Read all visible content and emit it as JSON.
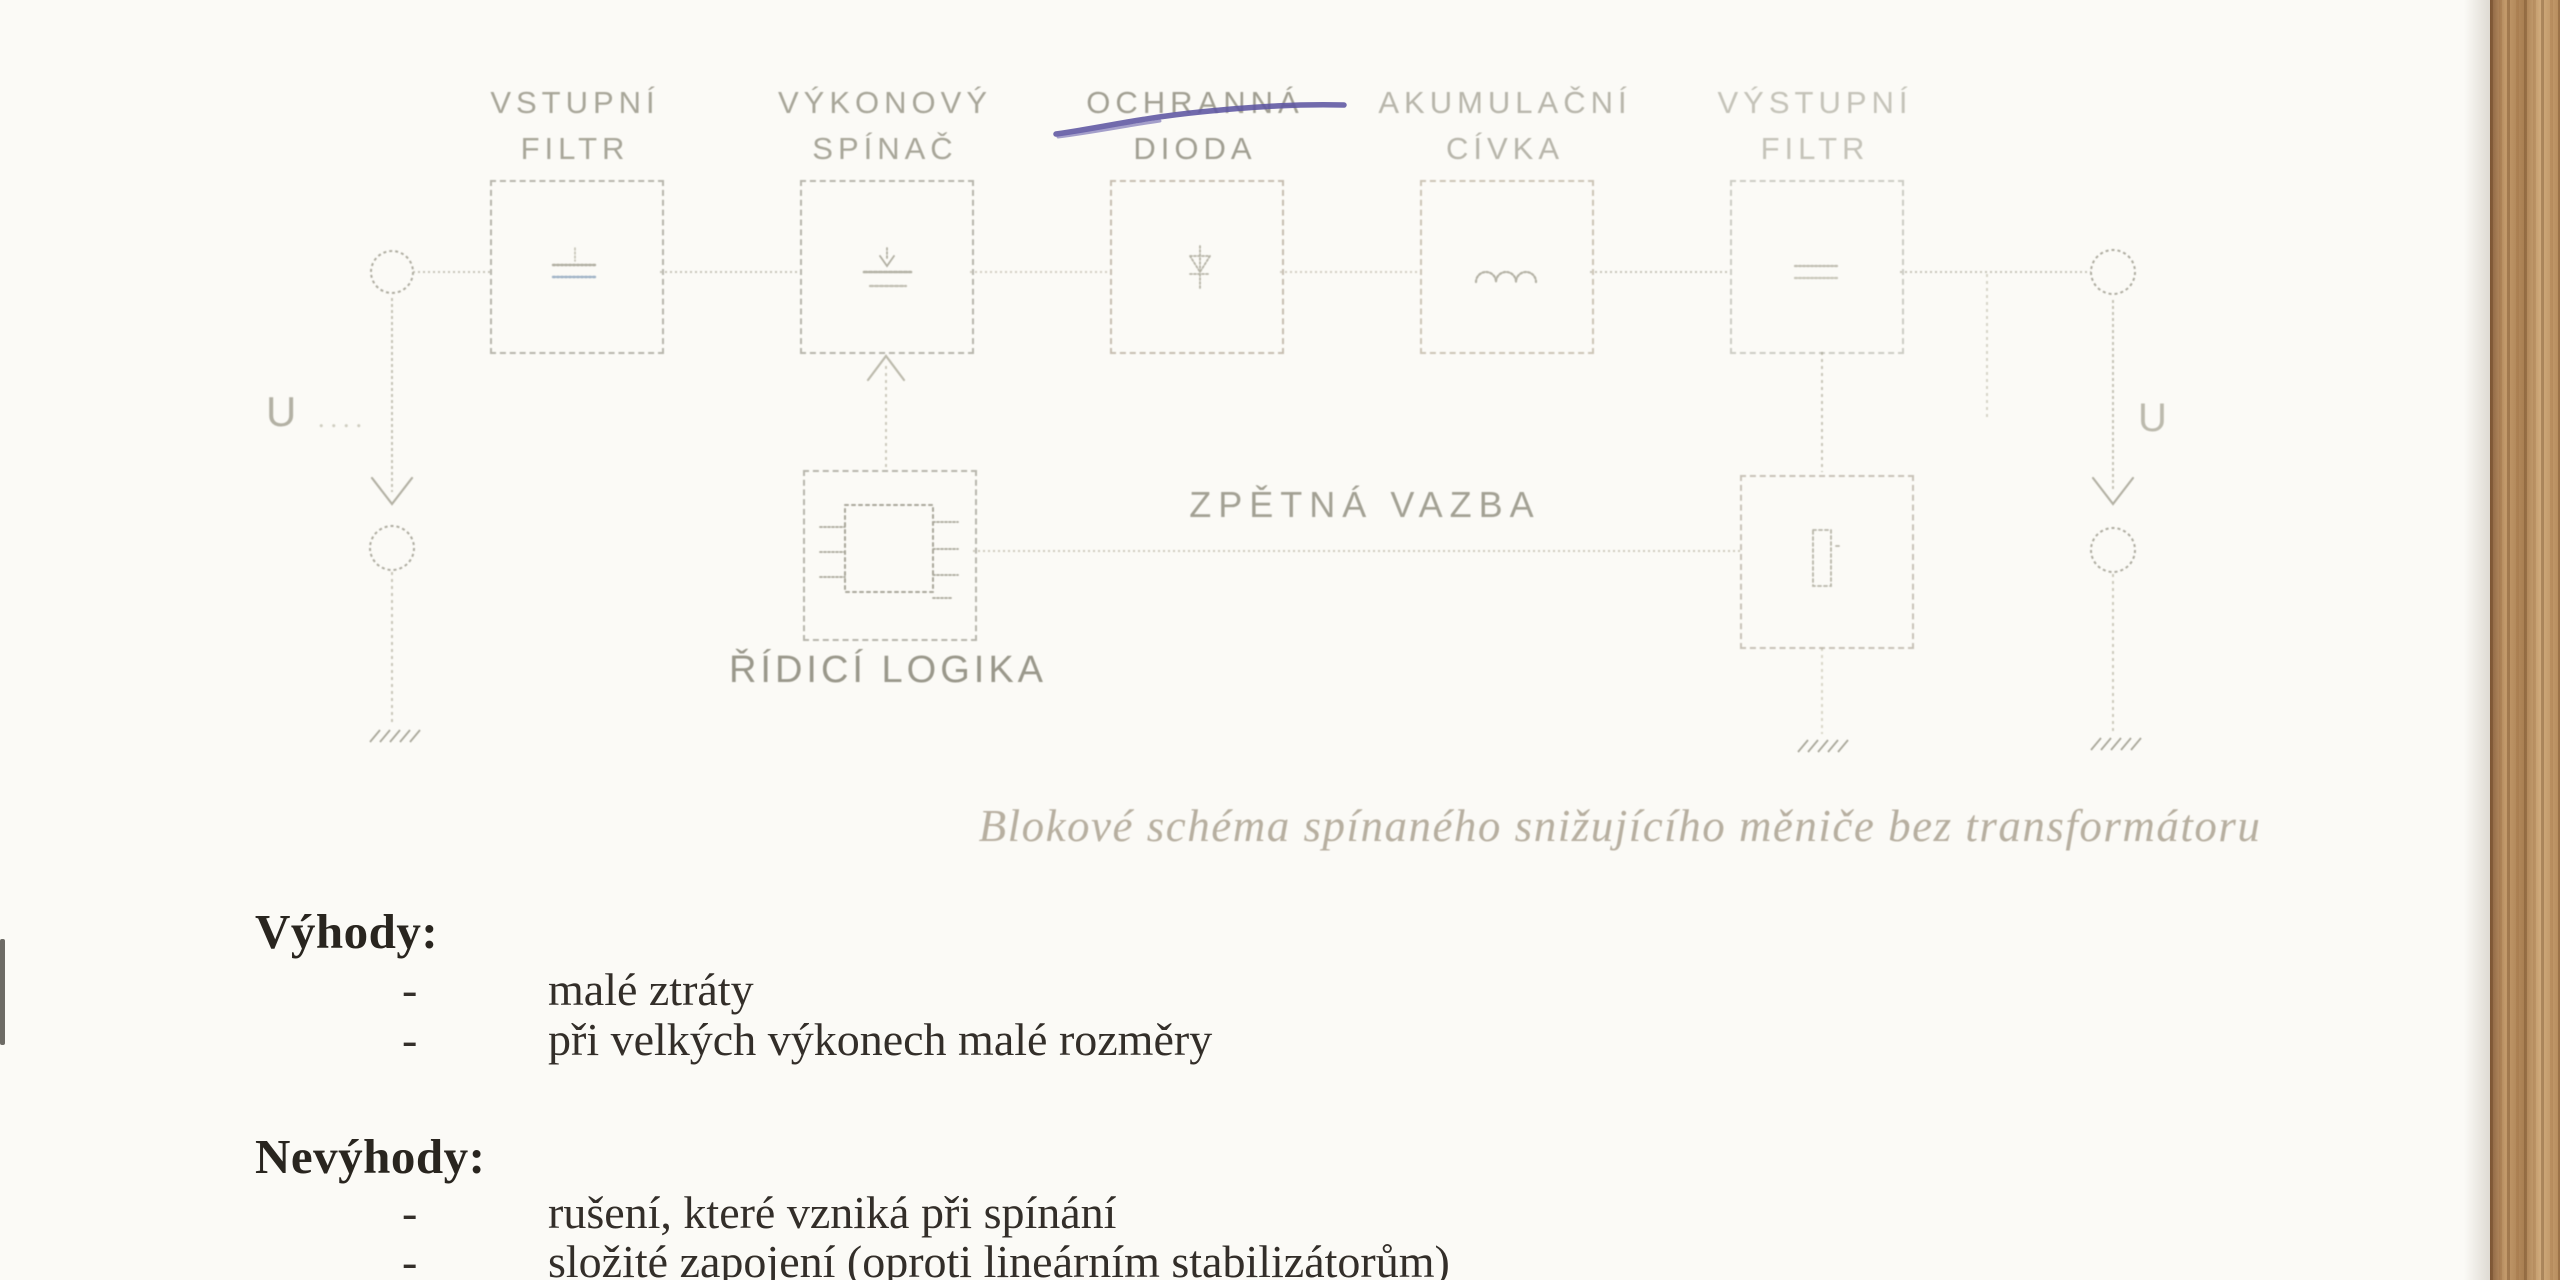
{
  "page": {
    "kind": "scanned textbook page",
    "language": "cs",
    "colors": {
      "paper": "#fbfaf6",
      "diagram_line": "#c6c4b7",
      "pen_ink": "#5d55a2",
      "body_text": "#2f2b26",
      "wood_desk": "#b5895f"
    }
  },
  "diagram": {
    "blocks": [
      {
        "line1": "VSTUPNÍ",
        "line2": "FILTR",
        "symbol": "capacitor-filter-icon"
      },
      {
        "line1": "VÝKONOVÝ",
        "line2": "SPÍNAČ",
        "symbol": "transistor-switch-icon"
      },
      {
        "line1": "OCHRANNÁ",
        "line2": "DIODA",
        "symbol": "diode-icon",
        "pen_strike_line1": true
      },
      {
        "line1": "AKUMULAČNÍ",
        "line2": "CÍVKA",
        "symbol": "inductor-coil-icon"
      },
      {
        "line1": "VÝSTUPNÍ",
        "line2": "FILTR",
        "symbol": "capacitor-filter-icon"
      }
    ],
    "control_block": {
      "line1": "ŘÍDICÍ",
      "line2": "LOGIKA",
      "symbol": "ic-chip-icon"
    },
    "sense_block": {
      "symbol": "sensor-element-icon"
    },
    "feedback_label": "ZPĚTNÁ VAZBA",
    "input_terminal_label": "U",
    "input_terminal_suffix": "....",
    "output_terminal_label": "U",
    "caption": "Blokové schéma spínaného snižujícího měniče bez transformátoru"
  },
  "content": {
    "bullet": "-",
    "advantages_heading": "Výhody:",
    "advantages": [
      "malé ztráty",
      "při velkých výkonech malé rozměry"
    ],
    "disadvantages_heading": "Nevýhody:",
    "disadvantages": [
      "rušení, které vzniká při spínání",
      "složité zapojení (oproti lineárním stabilizátorům)"
    ]
  }
}
